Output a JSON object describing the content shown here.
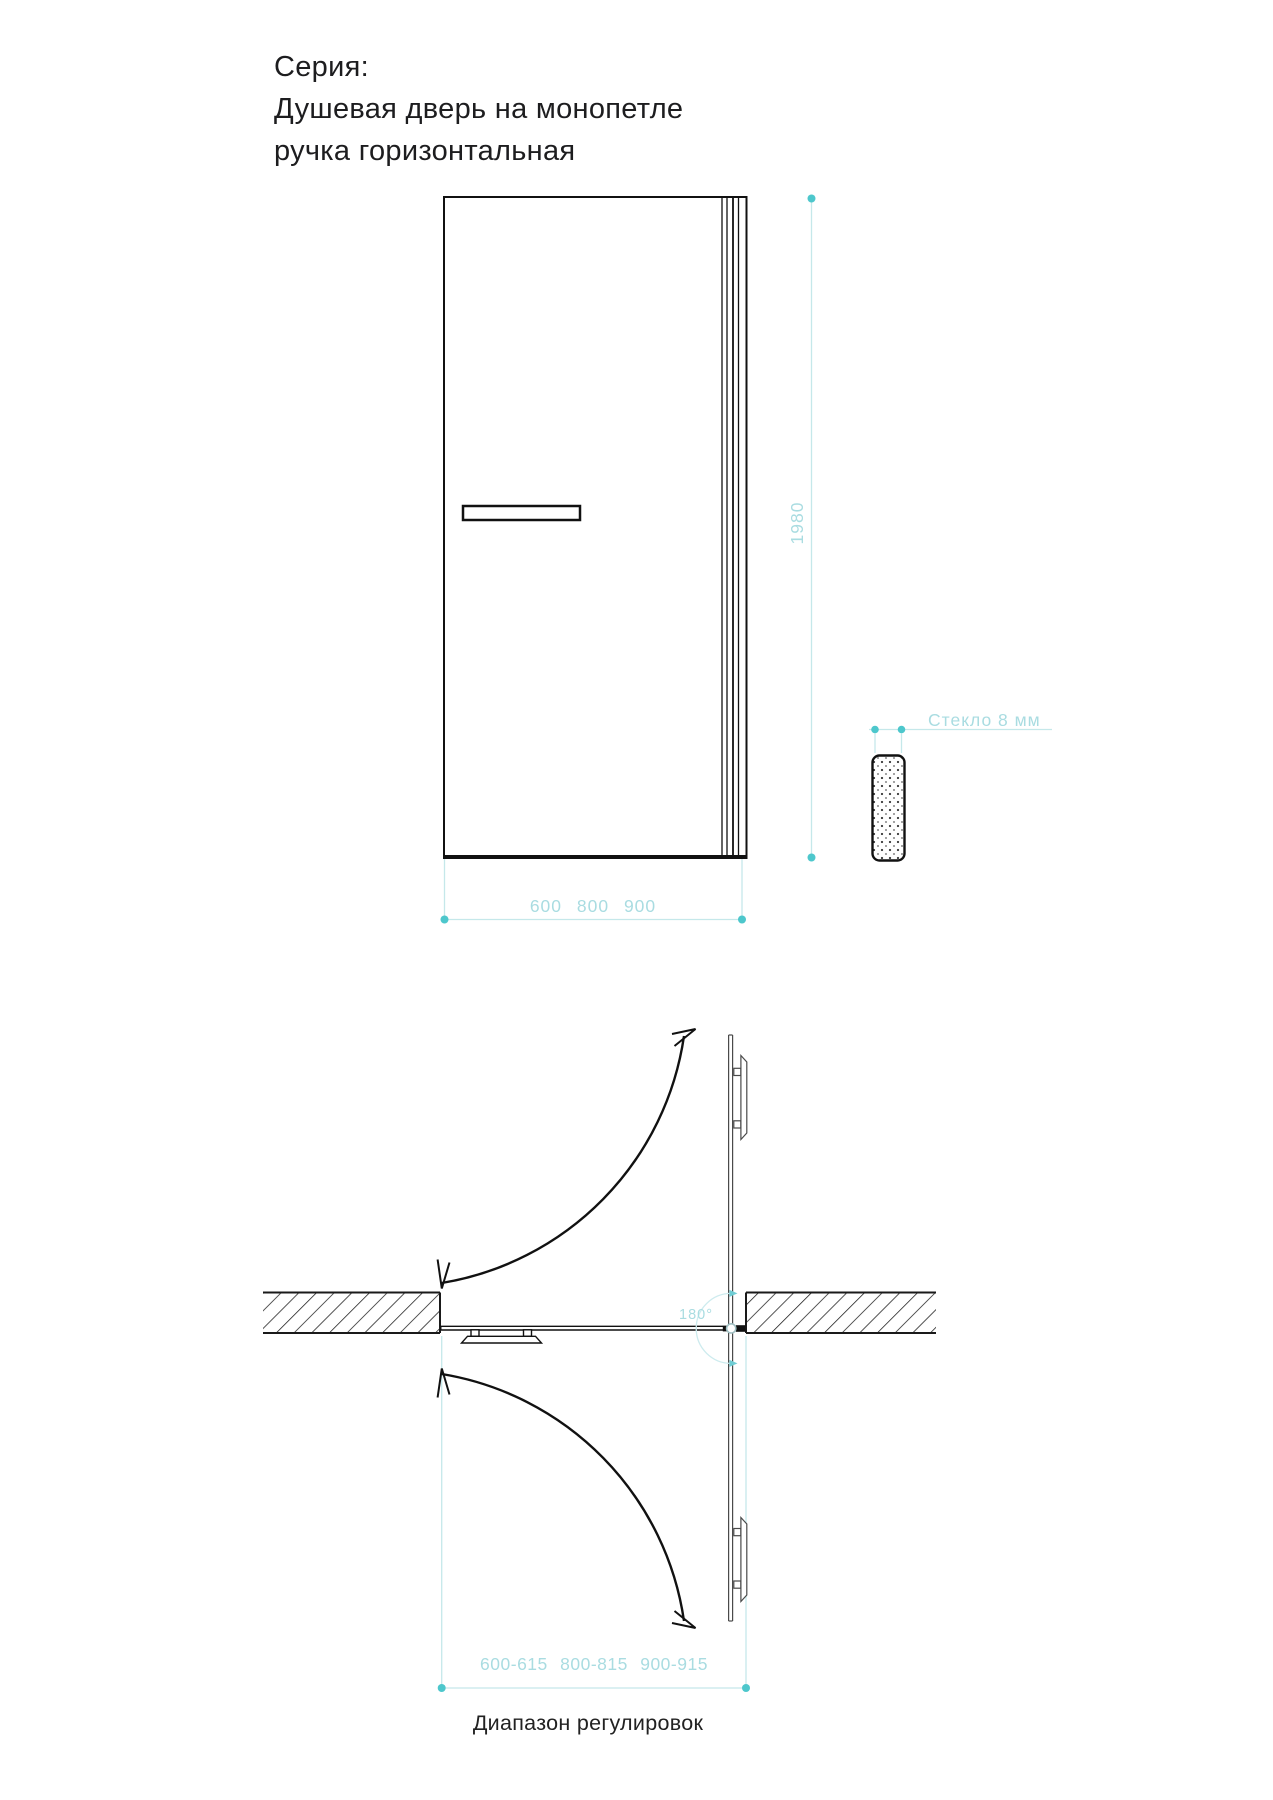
{
  "title": {
    "series_label": "Серия:",
    "line2": "Душевая дверь на монопетле",
    "line3": "ручка горизонтальная"
  },
  "front_view": {
    "height_dim": "1980",
    "width_dims": "600 800 900",
    "glass_label": "Стекло 8 мм"
  },
  "plan_view": {
    "angle_label": "180°",
    "range_dims": "600-615 800-815 900-915",
    "caption": "Диапазон регулировок"
  },
  "colors": {
    "line_black": "#1a1a1a",
    "open_door_gray": "#4a4a4a",
    "dim_line_teal": "#c5e8ea",
    "dim_dot_teal": "#4dc7cc",
    "dim_text_teal": "#a9dce1"
  }
}
